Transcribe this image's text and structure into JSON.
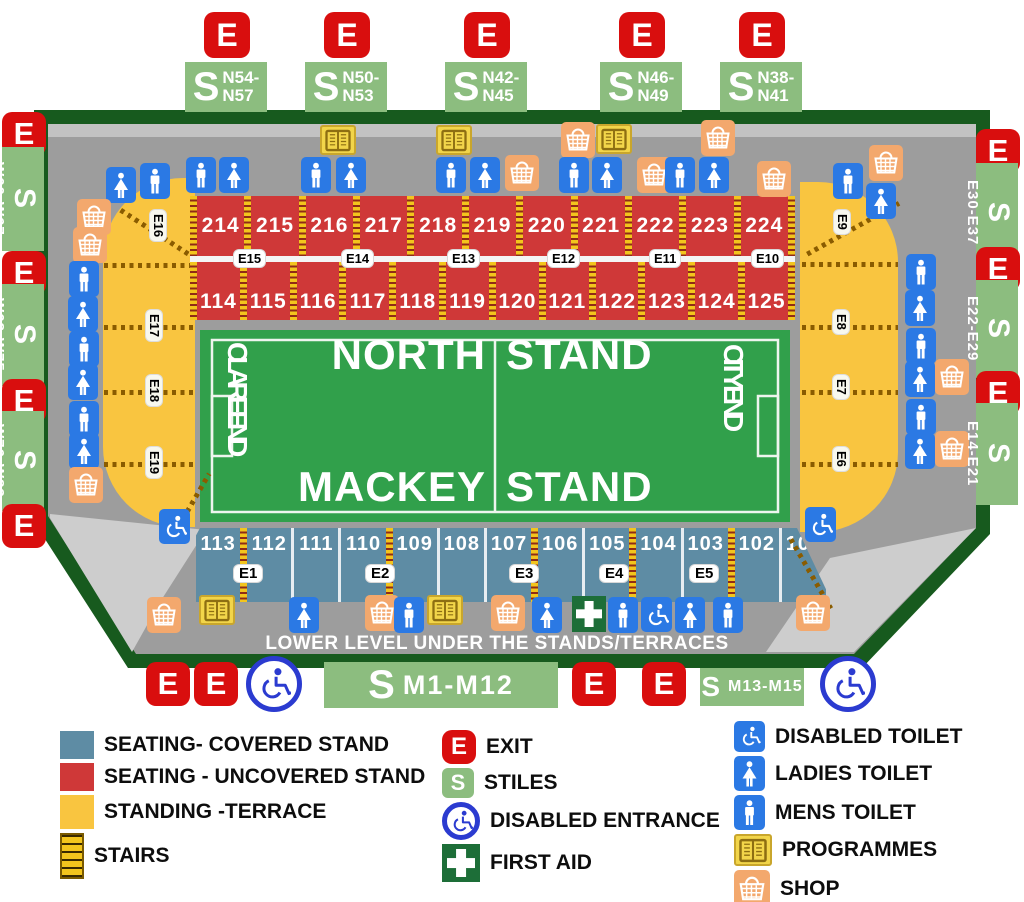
{
  "glyphs": {
    "exit": "E",
    "stiles": "S"
  },
  "pitch": {
    "north_left": "NORTH",
    "north_right": "STAND",
    "south_left": "MACKEY",
    "south_right": "STAND",
    "west_end": "CLARE END",
    "east_end": "CITY END"
  },
  "lower_level_text": "LOWER LEVEL  UNDER THE STANDS/TERRACES",
  "stands": {
    "upper": {
      "top": [
        "214",
        "215",
        "216",
        "217",
        "218",
        "219",
        "220",
        "221",
        "222",
        "223",
        "224"
      ],
      "bottom": [
        "114",
        "115",
        "116",
        "117",
        "118",
        "119",
        "120",
        "121",
        "122",
        "123",
        "124",
        "125"
      ],
      "exits": [
        {
          "label": "E15",
          "x": 44
        },
        {
          "label": "E14",
          "x": 152
        },
        {
          "label": "E13",
          "x": 258
        },
        {
          "label": "E12",
          "x": 358
        },
        {
          "label": "E11",
          "x": 460
        },
        {
          "label": "E10",
          "x": 562
        }
      ]
    },
    "lower": {
      "sections": [
        "113",
        "112",
        "111",
        "110",
        "109",
        "108",
        "107",
        "106",
        "105",
        "104",
        "103",
        "102",
        "101"
      ],
      "stairs_after": [
        0,
        3,
        6,
        8,
        10
      ],
      "exits": [
        {
          "label": "E1",
          "x": 74
        },
        {
          "label": "E2",
          "x": 206
        },
        {
          "label": "E3",
          "x": 350
        },
        {
          "label": "E4",
          "x": 440
        },
        {
          "label": "E5",
          "x": 530
        }
      ]
    }
  },
  "terraces": {
    "left": {
      "diag_exit": {
        "label": "E16"
      },
      "lines": [
        {
          "y": 263
        },
        {
          "y": 325,
          "label": "E17"
        },
        {
          "y": 390,
          "label": "E18"
        },
        {
          "y": 462,
          "label": "E19"
        }
      ]
    },
    "right": {
      "diag_exit": {
        "label": "E9"
      },
      "lines": [
        {
          "y": 262
        },
        {
          "y": 325,
          "label": "E8"
        },
        {
          "y": 390,
          "label": "E7"
        },
        {
          "y": 462,
          "label": "E6"
        }
      ]
    }
  },
  "gates": {
    "top": [
      {
        "lines": [
          "N54-",
          "N57"
        ],
        "x": 185
      },
      {
        "lines": [
          "N50-",
          "N53"
        ],
        "x": 305
      },
      {
        "lines": [
          "N42-",
          "N45"
        ],
        "x": 445
      },
      {
        "lines": [
          "N46-",
          "N49"
        ],
        "x": 600
      },
      {
        "lines": [
          "N38-",
          "N41"
        ],
        "x": 720
      }
    ],
    "left": [
      {
        "type": "exit",
        "y": 112
      },
      {
        "type": "stiles",
        "label": "W60-W67",
        "y": 147,
        "h": 104
      },
      {
        "type": "exit",
        "y": 251
      },
      {
        "type": "stiles",
        "label": "W68-W75",
        "y": 284,
        "h": 102
      },
      {
        "type": "exit",
        "y": 379
      },
      {
        "type": "stiles",
        "label": "W76-W83",
        "y": 411,
        "h": 100
      },
      {
        "type": "exit",
        "y": 504
      }
    ],
    "right": [
      {
        "type": "exit",
        "y": 129
      },
      {
        "type": "stiles",
        "label": "E30-E37",
        "y": 163,
        "h": 100
      },
      {
        "type": "exit",
        "y": 247
      },
      {
        "type": "stiles",
        "label": "E22-E29",
        "y": 280,
        "h": 98
      },
      {
        "type": "exit",
        "y": 371
      },
      {
        "type": "stiles",
        "label": "E14-E21",
        "y": 403,
        "h": 102
      }
    ],
    "bottom": [
      {
        "type": "exit",
        "x": 146
      },
      {
        "type": "exit",
        "x": 194
      },
      {
        "type": "disabled",
        "x": 246
      },
      {
        "type": "stiles",
        "label": "M1-M12",
        "x": 324,
        "w": 234,
        "h": 46,
        "big": true
      },
      {
        "type": "exit",
        "x": 572
      },
      {
        "type": "exit",
        "x": 642
      },
      {
        "type": "stiles",
        "label": "M13-M15",
        "x": 700,
        "w": 104,
        "h": 38,
        "big": false
      },
      {
        "type": "disabled",
        "x": 820
      }
    ]
  },
  "facility_icons": [
    {
      "t": "mens",
      "x": 186,
      "y": 157
    },
    {
      "t": "ladies",
      "x": 219,
      "y": 157
    },
    {
      "t": "programmes",
      "x": 320,
      "y": 125
    },
    {
      "t": "mens",
      "x": 301,
      "y": 157
    },
    {
      "t": "ladies",
      "x": 336,
      "y": 157
    },
    {
      "t": "programmes",
      "x": 436,
      "y": 125
    },
    {
      "t": "mens",
      "x": 436,
      "y": 157
    },
    {
      "t": "ladies",
      "x": 470,
      "y": 157
    },
    {
      "t": "shop",
      "x": 505,
      "y": 155
    },
    {
      "t": "shop",
      "x": 561,
      "y": 122
    },
    {
      "t": "programmes",
      "x": 596,
      "y": 124
    },
    {
      "t": "mens",
      "x": 559,
      "y": 157
    },
    {
      "t": "ladies",
      "x": 592,
      "y": 157
    },
    {
      "t": "shop",
      "x": 637,
      "y": 157
    },
    {
      "t": "shop",
      "x": 701,
      "y": 120
    },
    {
      "t": "mens",
      "x": 665,
      "y": 157
    },
    {
      "t": "ladies",
      "x": 699,
      "y": 157
    },
    {
      "t": "shop",
      "x": 757,
      "y": 161
    },
    {
      "t": "mens",
      "x": 833,
      "y": 163
    },
    {
      "t": "shop",
      "x": 869,
      "y": 145
    },
    {
      "t": "ladies",
      "x": 866,
      "y": 183
    },
    {
      "t": "ladies",
      "x": 106,
      "y": 167
    },
    {
      "t": "mens",
      "x": 140,
      "y": 163
    },
    {
      "t": "shop",
      "x": 77,
      "y": 199
    },
    {
      "t": "shop",
      "x": 73,
      "y": 227
    },
    {
      "t": "mens",
      "x": 69,
      "y": 261
    },
    {
      "t": "ladies",
      "x": 68,
      "y": 296
    },
    {
      "t": "mens",
      "x": 69,
      "y": 331
    },
    {
      "t": "ladies",
      "x": 68,
      "y": 364
    },
    {
      "t": "mens",
      "x": 69,
      "y": 401
    },
    {
      "t": "ladies",
      "x": 69,
      "y": 433
    },
    {
      "t": "shop",
      "x": 69,
      "y": 467
    },
    {
      "t": "disabled-toilet",
      "x": 159,
      "y": 509
    },
    {
      "t": "mens",
      "x": 906,
      "y": 254
    },
    {
      "t": "ladies",
      "x": 905,
      "y": 290
    },
    {
      "t": "mens",
      "x": 906,
      "y": 328
    },
    {
      "t": "ladies",
      "x": 905,
      "y": 361
    },
    {
      "t": "shop",
      "x": 935,
      "y": 359
    },
    {
      "t": "mens",
      "x": 906,
      "y": 399
    },
    {
      "t": "ladies",
      "x": 905,
      "y": 433
    },
    {
      "t": "shop",
      "x": 935,
      "y": 431
    },
    {
      "t": "disabled-toilet",
      "x": 805,
      "y": 507
    },
    {
      "t": "shop",
      "x": 147,
      "y": 597
    },
    {
      "t": "programmes",
      "x": 199,
      "y": 595
    },
    {
      "t": "ladies",
      "x": 289,
      "y": 597
    },
    {
      "t": "shop",
      "x": 365,
      "y": 595
    },
    {
      "t": "mens",
      "x": 394,
      "y": 597
    },
    {
      "t": "programmes",
      "x": 427,
      "y": 595
    },
    {
      "t": "shop",
      "x": 491,
      "y": 595
    },
    {
      "t": "ladies",
      "x": 532,
      "y": 597
    },
    {
      "t": "first-aid",
      "x": 572,
      "y": 596
    },
    {
      "t": "mens",
      "x": 608,
      "y": 597
    },
    {
      "t": "disabled-toilet",
      "x": 641,
      "y": 597
    },
    {
      "t": "ladies",
      "x": 675,
      "y": 597
    },
    {
      "t": "mens",
      "x": 713,
      "y": 597
    },
    {
      "t": "shop",
      "x": 796,
      "y": 595
    }
  ],
  "legend": {
    "areas": [
      {
        "label": "SEATING- COVERED STAND",
        "color": "#5e8ca4",
        "h": 28
      },
      {
        "label": "SEATING - UNCOVERED STAND",
        "color": "#cf3838",
        "h": 28
      },
      {
        "label": "STANDING -TERRACE",
        "color": "#f9c540",
        "h": 34
      }
    ],
    "stairs_label": "STAIRS",
    "symbols": [
      {
        "label": "EXIT",
        "icon": "exit"
      },
      {
        "label": "STILES",
        "icon": "stiles"
      },
      {
        "label": "DISABLED ENTRANCE",
        "icon": "disabled-entrance"
      },
      {
        "label": "FIRST AID",
        "icon": "first-aid"
      }
    ],
    "facilities": [
      {
        "label": "DISABLED TOILET",
        "icon": "disabled-toilet"
      },
      {
        "label": "LADIES TOILET",
        "icon": "ladies"
      },
      {
        "label": "MENS TOILET",
        "icon": "mens"
      },
      {
        "label": "PROGRAMMES",
        "icon": "programmes"
      },
      {
        "label": "SHOP",
        "icon": "shop"
      }
    ]
  }
}
